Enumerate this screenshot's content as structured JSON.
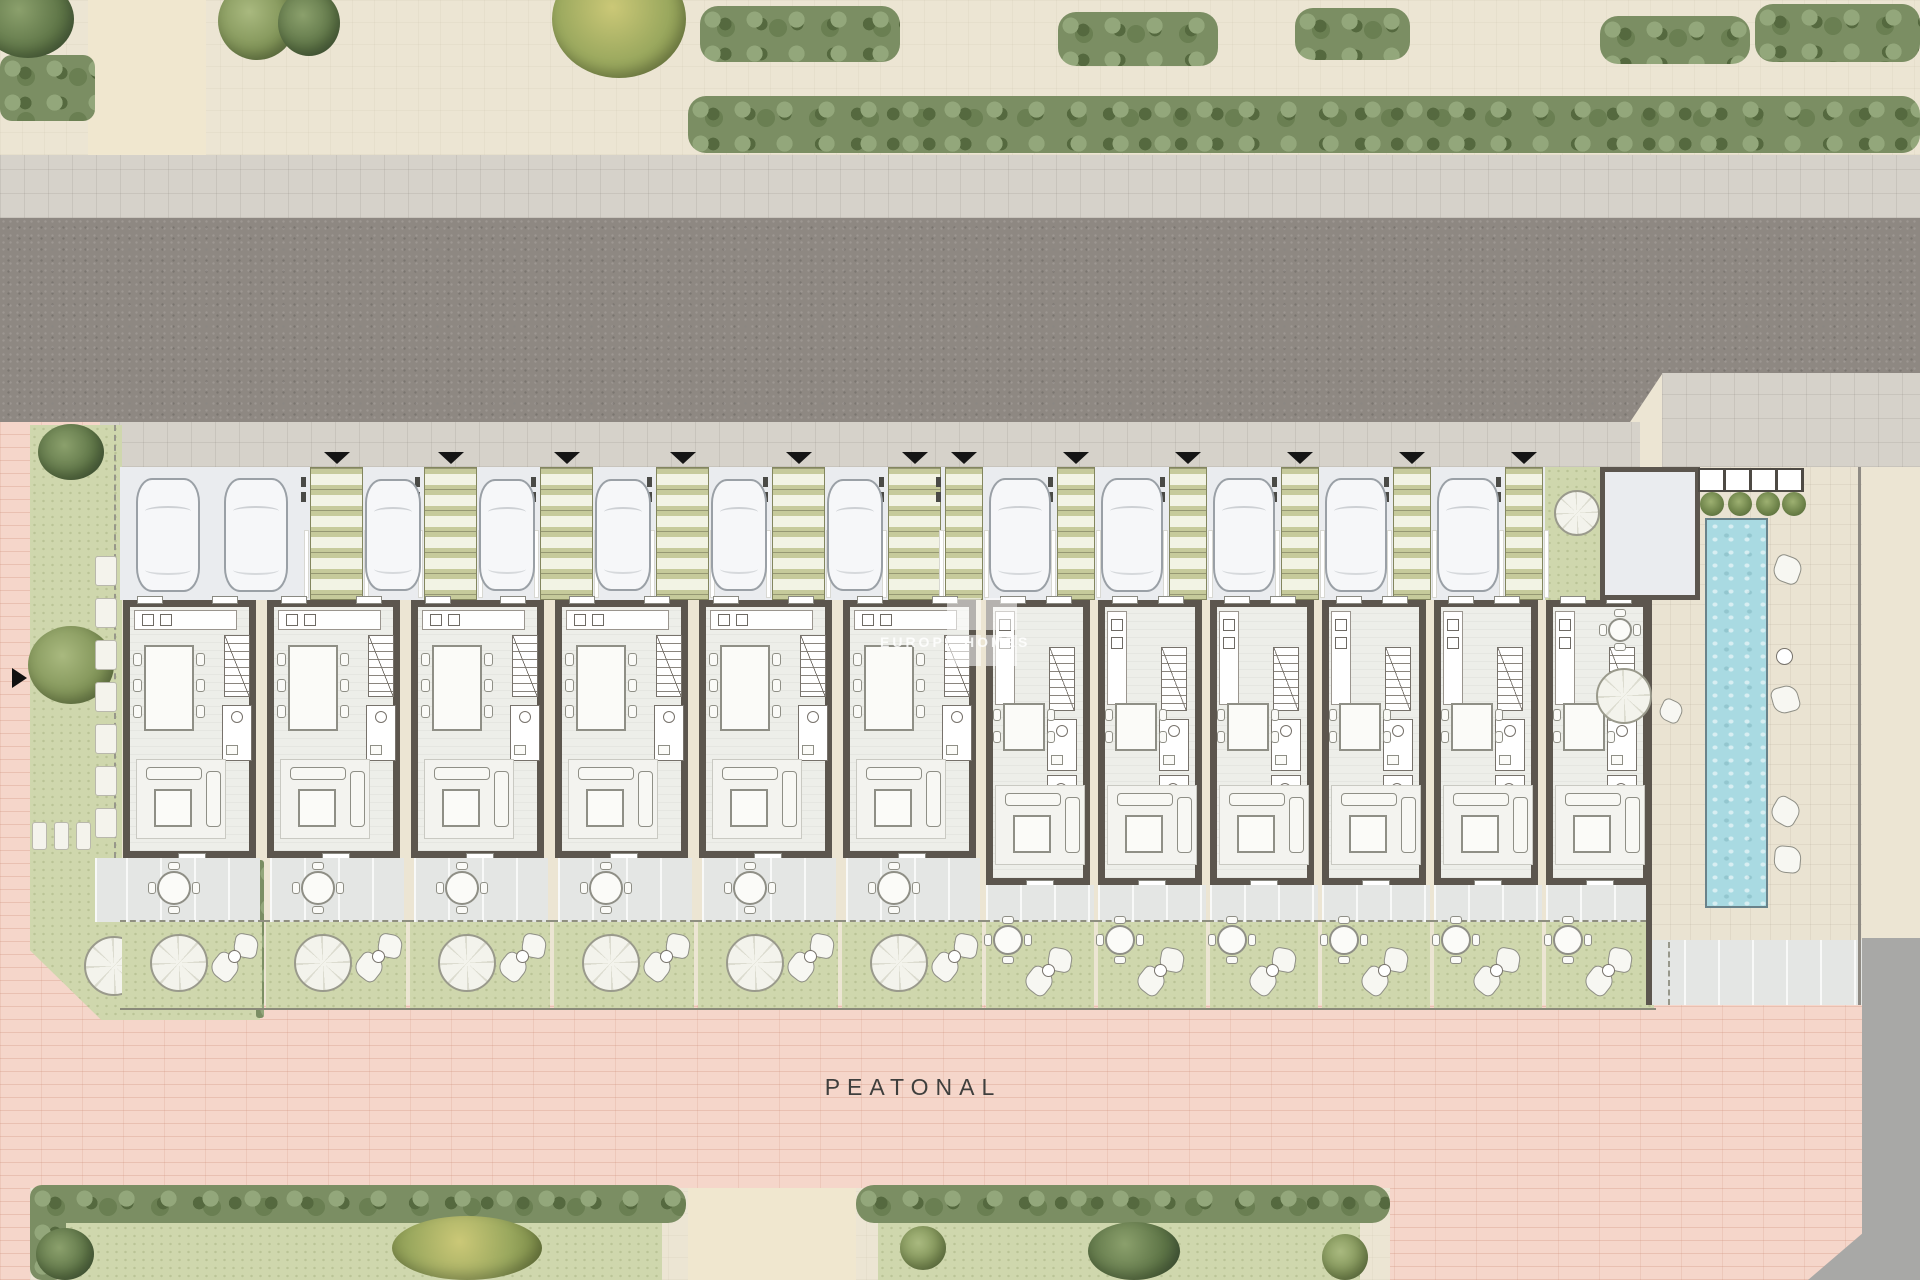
{
  "document": {
    "type": "architectural site plan",
    "view": "ground floor masterplan, top-down",
    "street_side": "asphalt road along the top",
    "pedestrian_side": "pink paved promenade along the bottom"
  },
  "labels": {
    "pedestrian_street": "PEATONAL"
  },
  "watermark": {
    "logo_text": "FH",
    "brand_text": "EUROPE HOMES"
  },
  "site": {
    "units": [
      {
        "id": "01",
        "section": "A",
        "plan": "wide townhouse",
        "parking": "double pad with 2 cars",
        "terrace": [
          "round-table"
        ],
        "garden": [
          "parasol",
          "cushions"
        ]
      },
      {
        "id": "02",
        "section": "A",
        "plan": "wide townhouse",
        "parking": "car pad",
        "terrace": [
          "round-table"
        ],
        "garden": [
          "parasol",
          "cushions"
        ]
      },
      {
        "id": "03",
        "section": "A",
        "plan": "wide townhouse",
        "parking": "car pad",
        "terrace": [
          "round-table"
        ],
        "garden": [
          "parasol",
          "cushions"
        ]
      },
      {
        "id": "04",
        "section": "A",
        "plan": "wide townhouse",
        "parking": "car pad",
        "terrace": [
          "round-table"
        ],
        "garden": [
          "parasol",
          "cushions"
        ]
      },
      {
        "id": "05",
        "section": "A",
        "plan": "wide townhouse",
        "parking": "car pad",
        "terrace": [
          "round-table"
        ],
        "garden": [
          "parasol",
          "cushions"
        ]
      },
      {
        "id": "06",
        "section": "A",
        "plan": "wide townhouse",
        "parking": "car pad",
        "terrace": [
          "round-table"
        ],
        "garden": [
          "parasol",
          "cushions"
        ]
      },
      {
        "id": "07",
        "section": "B",
        "plan": "narrow townhouse",
        "parking": "car pad",
        "terrace": [],
        "garden": [
          "round-table",
          "cushions"
        ]
      },
      {
        "id": "08",
        "section": "B",
        "plan": "narrow townhouse",
        "parking": "car pad",
        "terrace": [],
        "garden": [
          "round-table",
          "cushions"
        ]
      },
      {
        "id": "09",
        "section": "B",
        "plan": "narrow townhouse",
        "parking": "car pad",
        "terrace": [],
        "garden": [
          "round-table",
          "cushions"
        ]
      },
      {
        "id": "10",
        "section": "B",
        "plan": "narrow townhouse",
        "parking": "car pad",
        "terrace": [],
        "garden": [
          "round-table",
          "cushions"
        ]
      },
      {
        "id": "11",
        "section": "B",
        "plan": "narrow townhouse",
        "parking": "car pad",
        "terrace": [],
        "garden": [
          "round-table",
          "cushions"
        ]
      },
      {
        "id": "12",
        "section": "B",
        "plan": "narrow townhouse",
        "parking": "garage with car",
        "terrace": [],
        "garden": [
          "round-table",
          "cushions"
        ]
      }
    ],
    "parking": {
      "car_count": 13,
      "entry_marker_count": 12,
      "stepping_path_count": 12
    },
    "amenities": {
      "pool": {
        "shape": "long rectangular lap pool",
        "color": "#a9dae2"
      },
      "pool_deck": "east end deck with pergola, planting, side table and lounging cushions",
      "communal_garden_west": "corner garden with outdoor dining table, parasol and cushions",
      "communal_corner_east": "small garden nook with parasol between last garage and pool court"
    },
    "landscape": {
      "top_band": "street-side hedge row and trees with sandy footpaths",
      "bottom_band": "park strip with hedges, lawns and trees",
      "private_gardens": "one per unit, separated by dashed boundaries"
    }
  },
  "colors": {
    "road": "#8e8882",
    "sidewalk": "#d6d2ca",
    "cream_paving": "#ece5d3",
    "pink_paving": "#f5d6ca",
    "garden_green": "#cfd7ad",
    "hedge_green": "#7b8e63",
    "wall_dark": "#5c564e",
    "pool_blue": "#a9dae2",
    "marker_black": "#151515"
  }
}
